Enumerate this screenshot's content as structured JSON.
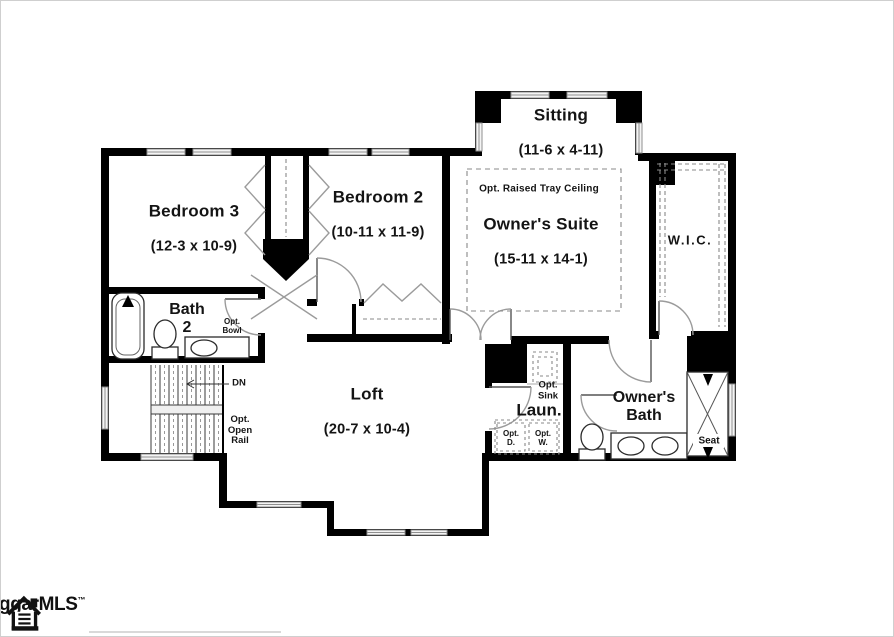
{
  "rooms": {
    "sitting": {
      "name": "Sitting",
      "dims": "(11-6 x 4-11)"
    },
    "owners_suite": {
      "note": "Opt. Raised Tray Ceiling",
      "name": "Owner's Suite",
      "dims": "(15-11 x 14-1)"
    },
    "wic": {
      "name": "W.I.C."
    },
    "bedroom3": {
      "name": "Bedroom 3",
      "dims": "(12-3 x 10-9)"
    },
    "bedroom2": {
      "name": "Bedroom 2",
      "dims": "(10-11 x 11-9)"
    },
    "bath2": {
      "name": "Bath\n2"
    },
    "loft": {
      "name": "Loft",
      "dims": "(20-7 x 10-4)"
    },
    "laundry": {
      "name": "Laun."
    },
    "owners_bath": {
      "name": "Owner's\nBath"
    }
  },
  "annotations": {
    "opt_bowl": "Opt.\nBowl",
    "stairs_down": "DN",
    "opt_open_rail": "Opt.\nOpen\nRail",
    "opt_sink": "Opt.\nSink",
    "opt_dryer": "Opt.\nD.",
    "opt_washer": "Opt.\nW.",
    "shower_seat": "Seat"
  },
  "branding": {
    "mls_text": "ggarMLS",
    "trademark": "™"
  },
  "colors": {
    "wall": "#000000",
    "window_line": "#8f8f8f",
    "door_arc": "#9b9b9b",
    "dashed_line": "#888888",
    "background": "#ffffff",
    "frame": "#cfcfcf"
  }
}
